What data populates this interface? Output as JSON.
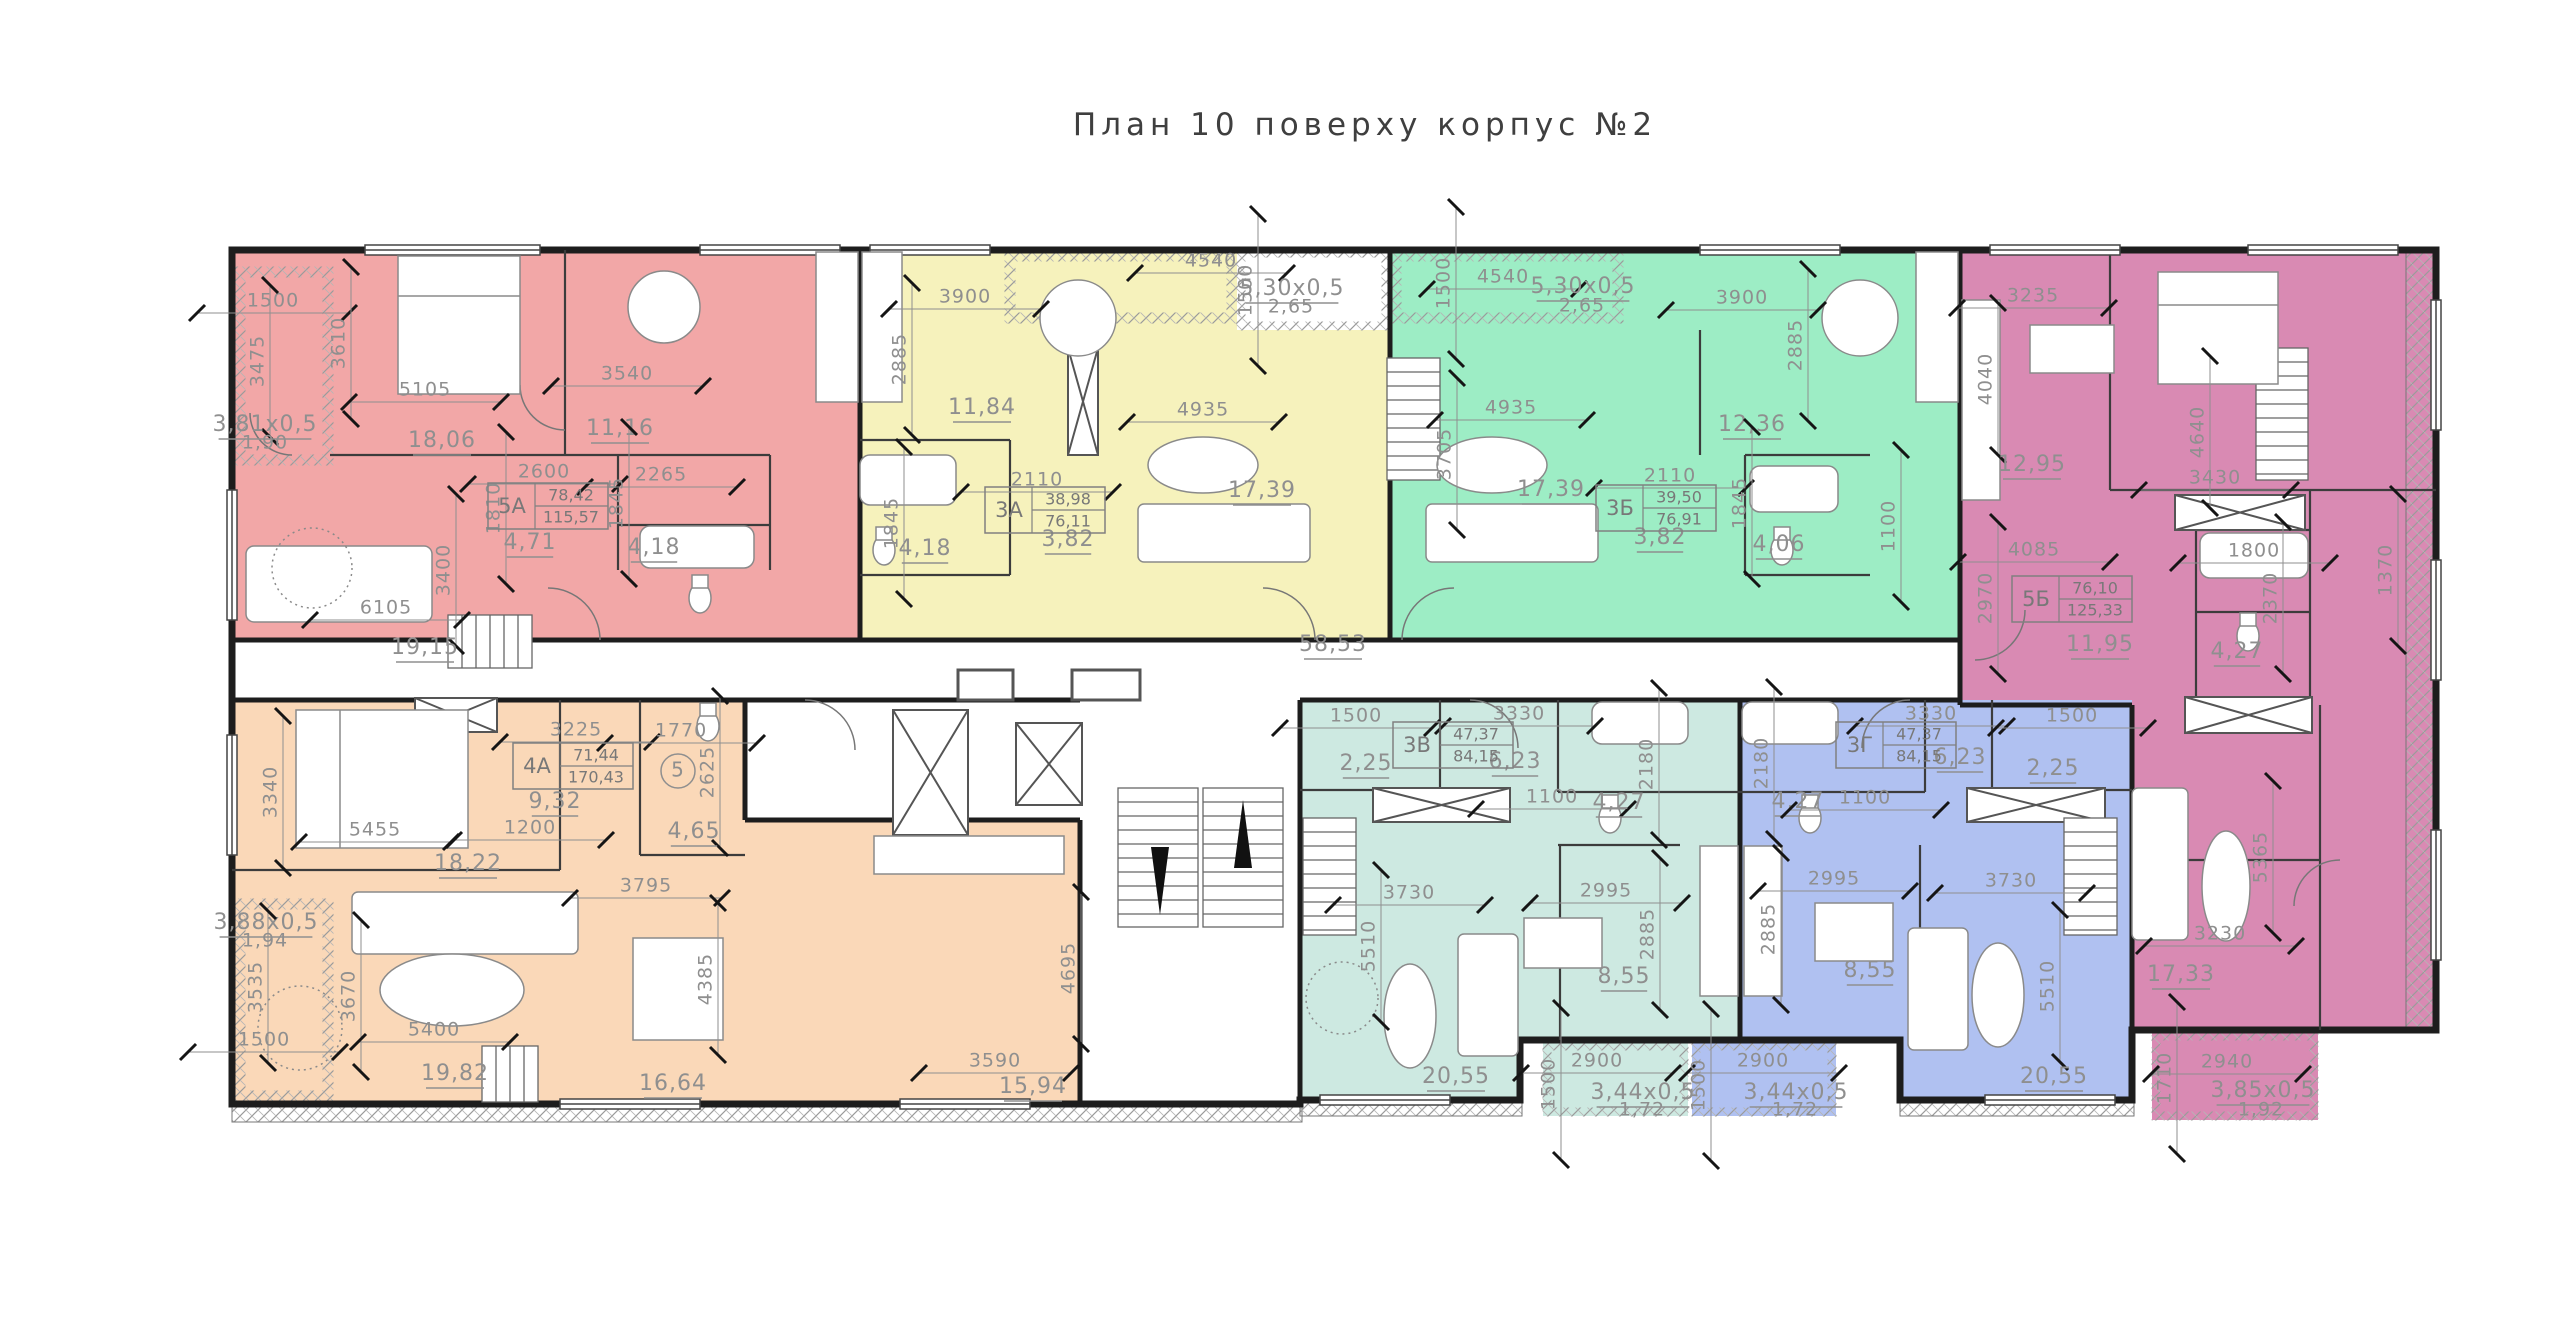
{
  "title": "План 10 поверху корпус №2",
  "colors": {
    "red": "#f2a7a7",
    "yellow": "#f6f2bc",
    "green": "#9dedc5",
    "purple": "#d98ab3",
    "orange": "#fad8b8",
    "teal": "#cde9e1",
    "blue": "#b0c1f1",
    "wall": "#1d1d1d",
    "partition": "#3c3c3c",
    "dim": "#8f8f8f",
    "furniture": "#8a8a8a",
    "hatch": "#9b9b9b",
    "tick": "#151515",
    "title": "#3f3f3f"
  },
  "apartments": [
    {
      "id": "5А",
      "color_key": "red",
      "area_living": "78,42",
      "area_total": "115,57",
      "x": 548,
      "y": 506
    },
    {
      "id": "3А",
      "color_key": "yellow",
      "area_living": "38,98",
      "area_total": "76,11",
      "x": 1045,
      "y": 510
    },
    {
      "id": "3Б",
      "color_key": "green",
      "area_living": "39,50",
      "area_total": "76,91",
      "x": 1656,
      "y": 508
    },
    {
      "id": "5Б",
      "color_key": "purple",
      "area_living": "76,10",
      "area_total": "125,33",
      "x": 2072,
      "y": 599
    },
    {
      "id": "4А",
      "color_key": "orange",
      "area_living": "71,44",
      "area_total": "170,43",
      "x": 573,
      "y": 766
    },
    {
      "id": "3В",
      "color_key": "teal",
      "area_living": "47,37",
      "area_total": "84,15",
      "x": 1453,
      "y": 745
    },
    {
      "id": "3Г",
      "color_key": "blue",
      "area_living": "47,37",
      "area_total": "84,15",
      "x": 1896,
      "y": 745
    }
  ],
  "labels": [
    {
      "t": "1500",
      "x": 273,
      "y": 301,
      "k": "dim"
    },
    {
      "t": "3475",
      "x": 258,
      "y": 361,
      "r": -90,
      "k": "dim"
    },
    {
      "t": "3610",
      "x": 339,
      "y": 343,
      "r": -90,
      "k": "dim"
    },
    {
      "t": "5105",
      "x": 425,
      "y": 390,
      "k": "dim"
    },
    {
      "t": "3540",
      "x": 627,
      "y": 374,
      "k": "dim"
    },
    {
      "t": "3,81x0,5",
      "x": 265,
      "y": 425,
      "k": "area"
    },
    {
      "t": "1,90",
      "x": 265,
      "y": 443,
      "k": "plain"
    },
    {
      "t": "18,06",
      "x": 442,
      "y": 441,
      "k": "area"
    },
    {
      "t": "11,16",
      "x": 620,
      "y": 429,
      "k": "area"
    },
    {
      "t": "2600",
      "x": 544,
      "y": 472,
      "k": "dim"
    },
    {
      "t": "1810",
      "x": 494,
      "y": 508,
      "r": -90,
      "k": "dim"
    },
    {
      "t": "1845",
      "x": 617,
      "y": 503,
      "r": -90,
      "k": "dim"
    },
    {
      "t": "2265",
      "x": 661,
      "y": 475,
      "k": "dim"
    },
    {
      "t": "4,71",
      "x": 530,
      "y": 543,
      "k": "area"
    },
    {
      "t": "4,18",
      "x": 654,
      "y": 548,
      "k": "area"
    },
    {
      "t": "3400",
      "x": 444,
      "y": 570,
      "r": -90,
      "k": "dim"
    },
    {
      "t": "6105",
      "x": 386,
      "y": 608,
      "k": "dim"
    },
    {
      "t": "19,15",
      "x": 425,
      "y": 648,
      "k": "area"
    },
    {
      "t": "3900",
      "x": 965,
      "y": 297,
      "k": "dim"
    },
    {
      "t": "2885",
      "x": 900,
      "y": 359,
      "r": -90,
      "k": "dim"
    },
    {
      "t": "11,84",
      "x": 982,
      "y": 408,
      "k": "area"
    },
    {
      "t": "4540",
      "x": 1211,
      "y": 261,
      "k": "dim"
    },
    {
      "t": "1500",
      "x": 1246,
      "y": 290,
      "r": -90,
      "k": "dim"
    },
    {
      "t": "5,30x0,5",
      "x": 1292,
      "y": 289,
      "k": "area"
    },
    {
      "t": "2,65",
      "x": 1291,
      "y": 307,
      "k": "plain"
    },
    {
      "t": "4935",
      "x": 1203,
      "y": 410,
      "k": "dim"
    },
    {
      "t": "17,39",
      "x": 1262,
      "y": 491,
      "k": "area"
    },
    {
      "t": "2110",
      "x": 1037,
      "y": 480,
      "k": "dim"
    },
    {
      "t": "3,82",
      "x": 1068,
      "y": 540,
      "k": "area"
    },
    {
      "t": "4,18",
      "x": 925,
      "y": 549,
      "k": "area"
    },
    {
      "t": "1845",
      "x": 892,
      "y": 523,
      "r": -90,
      "k": "dim"
    },
    {
      "t": "4540",
      "x": 1503,
      "y": 277,
      "k": "dim"
    },
    {
      "t": "1500",
      "x": 1444,
      "y": 283,
      "r": -90,
      "k": "dim"
    },
    {
      "t": "5,30x0,5",
      "x": 1583,
      "y": 287,
      "k": "area"
    },
    {
      "t": "2,65",
      "x": 1582,
      "y": 306,
      "k": "plain"
    },
    {
      "t": "3900",
      "x": 1742,
      "y": 298,
      "k": "dim"
    },
    {
      "t": "2885",
      "x": 1796,
      "y": 345,
      "r": -90,
      "k": "dim"
    },
    {
      "t": "4935",
      "x": 1511,
      "y": 408,
      "k": "dim"
    },
    {
      "t": "3705",
      "x": 1445,
      "y": 454,
      "r": -90,
      "k": "dim"
    },
    {
      "t": "17,39",
      "x": 1551,
      "y": 490,
      "k": "area"
    },
    {
      "t": "12,36",
      "x": 1752,
      "y": 425,
      "k": "area"
    },
    {
      "t": "2110",
      "x": 1670,
      "y": 476,
      "k": "dim"
    },
    {
      "t": "3,82",
      "x": 1660,
      "y": 538,
      "k": "area"
    },
    {
      "t": "1845",
      "x": 1740,
      "y": 503,
      "r": -90,
      "k": "dim"
    },
    {
      "t": "4,06",
      "x": 1779,
      "y": 545,
      "k": "area"
    },
    {
      "t": "1100",
      "x": 1889,
      "y": 526,
      "r": -90,
      "k": "dim"
    },
    {
      "t": "3235",
      "x": 2033,
      "y": 296,
      "k": "dim"
    },
    {
      "t": "4040",
      "x": 1986,
      "y": 379,
      "r": -90,
      "k": "dim"
    },
    {
      "t": "12,95",
      "x": 2032,
      "y": 465,
      "k": "area"
    },
    {
      "t": "4640",
      "x": 2198,
      "y": 432,
      "r": -90,
      "k": "dim"
    },
    {
      "t": "3430",
      "x": 2215,
      "y": 478,
      "k": "dim"
    },
    {
      "t": "4085",
      "x": 2034,
      "y": 550,
      "k": "dim"
    },
    {
      "t": "1800",
      "x": 2254,
      "y": 551,
      "k": "dim"
    },
    {
      "t": "2970",
      "x": 1986,
      "y": 598,
      "r": -90,
      "k": "dim"
    },
    {
      "t": "11,95",
      "x": 2100,
      "y": 645,
      "k": "area"
    },
    {
      "t": "4,27",
      "x": 2237,
      "y": 652,
      "k": "area"
    },
    {
      "t": "2370",
      "x": 2271,
      "y": 598,
      "r": -90,
      "k": "dim"
    },
    {
      "t": "1370",
      "x": 2386,
      "y": 570,
      "r": -90,
      "k": "dim"
    },
    {
      "t": "5365",
      "x": 2261,
      "y": 857,
      "r": -90,
      "k": "dim"
    },
    {
      "t": "3230",
      "x": 2220,
      "y": 934,
      "k": "dim"
    },
    {
      "t": "17,33",
      "x": 2181,
      "y": 975,
      "k": "area"
    },
    {
      "t": "1710",
      "x": 2165,
      "y": 1078,
      "r": -90,
      "k": "dim"
    },
    {
      "t": "2940",
      "x": 2227,
      "y": 1062,
      "k": "dim"
    },
    {
      "t": "3,85x0,5",
      "x": 2263,
      "y": 1091,
      "k": "area"
    },
    {
      "t": "1,92",
      "x": 2261,
      "y": 1110,
      "k": "plain"
    },
    {
      "t": "3225",
      "x": 576,
      "y": 730,
      "k": "dim"
    },
    {
      "t": "1770",
      "x": 681,
      "y": 731,
      "k": "dim"
    },
    {
      "t": "9,32",
      "x": 555,
      "y": 802,
      "k": "area"
    },
    {
      "t": "1200",
      "x": 530,
      "y": 828,
      "k": "dim"
    },
    {
      "t": "18,22",
      "x": 468,
      "y": 864,
      "k": "area"
    },
    {
      "t": "2625",
      "x": 708,
      "y": 772,
      "r": -90,
      "k": "dim"
    },
    {
      "t": "4,65",
      "x": 694,
      "y": 832,
      "k": "area"
    },
    {
      "t": "3340",
      "x": 271,
      "y": 792,
      "r": -90,
      "k": "dim"
    },
    {
      "t": "5455",
      "x": 375,
      "y": 830,
      "k": "dim"
    },
    {
      "t": "3,88x0,5",
      "x": 266,
      "y": 923,
      "k": "area"
    },
    {
      "t": "1,94",
      "x": 265,
      "y": 941,
      "k": "plain"
    },
    {
      "t": "3535",
      "x": 256,
      "y": 987,
      "r": -90,
      "k": "dim"
    },
    {
      "t": "1500",
      "x": 264,
      "y": 1040,
      "k": "dim"
    },
    {
      "t": "3670",
      "x": 349,
      "y": 996,
      "r": -90,
      "k": "dim"
    },
    {
      "t": "5400",
      "x": 434,
      "y": 1030,
      "k": "dim"
    },
    {
      "t": "19,82",
      "x": 455,
      "y": 1074,
      "k": "area"
    },
    {
      "t": "3795",
      "x": 646,
      "y": 886,
      "k": "dim"
    },
    {
      "t": "4385",
      "x": 706,
      "y": 979,
      "r": -90,
      "k": "dim"
    },
    {
      "t": "16,64",
      "x": 673,
      "y": 1084,
      "k": "area"
    },
    {
      "t": "3590",
      "x": 995,
      "y": 1061,
      "k": "dim"
    },
    {
      "t": "15,94",
      "x": 1033,
      "y": 1087,
      "k": "area"
    },
    {
      "t": "4695",
      "x": 1069,
      "y": 968,
      "r": -90,
      "k": "dim"
    },
    {
      "t": "58,53",
      "x": 1333,
      "y": 645,
      "k": "area"
    },
    {
      "t": "1500",
      "x": 1356,
      "y": 716,
      "k": "dim"
    },
    {
      "t": "3330",
      "x": 1519,
      "y": 714,
      "k": "dim"
    },
    {
      "t": "2,25",
      "x": 1366,
      "y": 764,
      "k": "area"
    },
    {
      "t": "6,23",
      "x": 1515,
      "y": 762,
      "k": "area"
    },
    {
      "t": "1100",
      "x": 1552,
      "y": 797,
      "k": "dim"
    },
    {
      "t": "4,27",
      "x": 1619,
      "y": 803,
      "k": "area"
    },
    {
      "t": "2180",
      "x": 1647,
      "y": 764,
      "r": -90,
      "k": "dim"
    },
    {
      "t": "3730",
      "x": 1409,
      "y": 893,
      "k": "dim"
    },
    {
      "t": "2995",
      "x": 1606,
      "y": 891,
      "k": "dim"
    },
    {
      "t": "5510",
      "x": 1369,
      "y": 946,
      "r": -90,
      "k": "dim"
    },
    {
      "t": "2885",
      "x": 1648,
      "y": 934,
      "r": -90,
      "k": "dim"
    },
    {
      "t": "8,55",
      "x": 1624,
      "y": 977,
      "k": "area"
    },
    {
      "t": "20,55",
      "x": 1456,
      "y": 1077,
      "k": "area"
    },
    {
      "t": "1500",
      "x": 1549,
      "y": 1084,
      "r": -90,
      "k": "dim"
    },
    {
      "t": "2900",
      "x": 1597,
      "y": 1061,
      "k": "dim"
    },
    {
      "t": "3,44x0,5",
      "x": 1643,
      "y": 1093,
      "k": "area"
    },
    {
      "t": "1,72",
      "x": 1642,
      "y": 1110,
      "k": "plain"
    },
    {
      "t": "3330",
      "x": 1931,
      "y": 714,
      "k": "dim"
    },
    {
      "t": "1500",
      "x": 2072,
      "y": 716,
      "k": "dim"
    },
    {
      "t": "6,23",
      "x": 1960,
      "y": 758,
      "k": "area"
    },
    {
      "t": "2,25",
      "x": 2053,
      "y": 769,
      "k": "area"
    },
    {
      "t": "4,27",
      "x": 1798,
      "y": 802,
      "k": "area"
    },
    {
      "t": "1100",
      "x": 1865,
      "y": 798,
      "k": "dim"
    },
    {
      "t": "2180",
      "x": 1762,
      "y": 763,
      "r": -90,
      "k": "dim"
    },
    {
      "t": "2995",
      "x": 1834,
      "y": 879,
      "k": "dim"
    },
    {
      "t": "2885",
      "x": 1769,
      "y": 929,
      "r": -90,
      "k": "dim"
    },
    {
      "t": "3730",
      "x": 2011,
      "y": 881,
      "k": "dim"
    },
    {
      "t": "8,55",
      "x": 1870,
      "y": 971,
      "k": "area"
    },
    {
      "t": "5510",
      "x": 2048,
      "y": 986,
      "r": -90,
      "k": "dim"
    },
    {
      "t": "20,55",
      "x": 2054,
      "y": 1077,
      "k": "area"
    },
    {
      "t": "2900",
      "x": 1763,
      "y": 1061,
      "k": "dim"
    },
    {
      "t": "1500",
      "x": 1699,
      "y": 1085,
      "r": -90,
      "k": "dim"
    },
    {
      "t": "3,44x0,5",
      "x": 1796,
      "y": 1093,
      "k": "area"
    },
    {
      "t": "1,72",
      "x": 1795,
      "y": 1110,
      "k": "plain"
    },
    {
      "t": "5",
      "x": 678,
      "y": 771,
      "k": "circle"
    }
  ]
}
